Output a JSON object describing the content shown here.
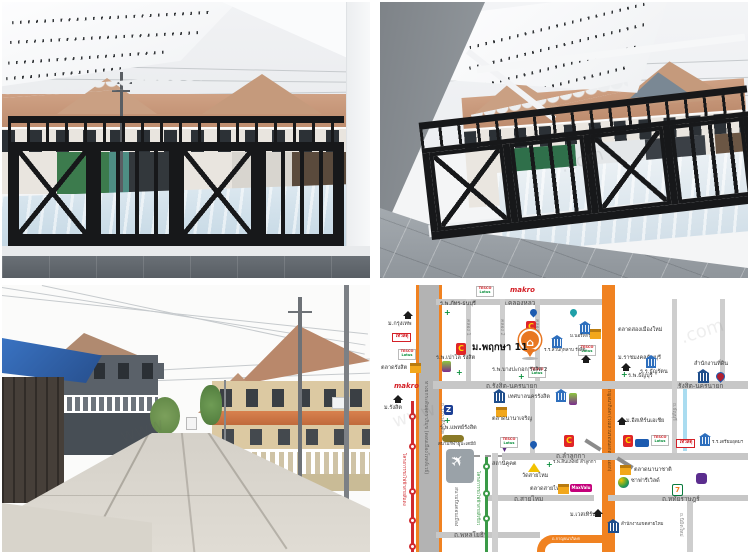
{
  "map": {
    "project": {
      "name": "ม.พฤกษา 11",
      "pin_glyph": "⌂"
    },
    "roads": {
      "klong_luang": "ถ.คลองหลวง",
      "rangsit_nakhonnayok": "ถ.รังสิต-นครนายก",
      "lam_lukka": "ถ.ลำลูกกา",
      "sai_mai": "ถ.สายไหม",
      "hathairat": "ถ.หทัยราษฎร์",
      "phahonyothin": "ถ.พหลโยธิน",
      "vibhavadi": "ถ.วิภาวดีรังสิต",
      "tollway": "ทางยกระดับอุตราภิมุข (ดอนเมืองโทลล์เวย์)",
      "kanchanaphisek": "ถ.กาญจนาภิเษก (วงแหวนรอบนอกตะวันออก)",
      "kanchanaphisek_short": "ถ.กาญจนาภิเษก",
      "nimit_mai": "ถ.นิมิตใหม่",
      "thanyaburi": "ถ.ธัญบุรี",
      "klong1": "คลอง 1",
      "klong2": "คลอง 2",
      "klong3": "คลอง 3"
    },
    "transit": {
      "red_line": "โครงการรถไฟฟ้าสายสีแดง",
      "green_line": "โครงการรถไฟฟ้าสายสีเขียว",
      "khu_khot": "สถานีคูคต",
      "don_mueang": "สนามบินดอนเมือง",
      "plane_glyph": "✈"
    },
    "places": {
      "bangkok_u": "ม.กรุงเทพ",
      "rangsit_u": "ม.รังสิต",
      "talad_rangsit": "ตลาดรังสิต",
      "phat_hospital": "ร.พ.ภัทร-ธนบุรี",
      "paolo_hospital": "ร.พ.เปาโล รังสิต",
      "bangpakok_hospital": "ร.พ.บางปะกอก รังสิต 2",
      "suan_kularb": "ร.ร.สวนกุหลาบ รังสิต",
      "north_bangkok_u": "ม.นอร์ทกรุงเทพ",
      "talad_muang_mai": "ตลาดสองเมืองใหม่",
      "rajamangala_u": "ม.ราชมงคลธัญบุรี",
      "thanyaburi_hospital": "ร.พ.ธัญบุรี",
      "thanyarat_school": "ร.ร.ธัญรัตน",
      "land_office": "สำนักงานที่ดิน",
      "city_hall": "เทศบาลนครรังสิต",
      "talad_nana_charoen": "ตลาดนานาเจริญ",
      "eastern_asia_u": "ม.อีสเทิร์นเอเชีย",
      "paet_rangsit_hospital": "ร.พ.แพทย์รังสิต",
      "stadium": "สนามกีฬาธูปะเตมีย์",
      "wat_sai_mai": "วัดสายไหม",
      "sinphaet_hospital": "ร.พ.สินแพทย์ ลำลูกกา",
      "talad_sai_mai": "ตลาดสายไหม",
      "talad_nana": "ตลาดนานาชาติ",
      "safari_world": "ซาฟารีเวิลด์",
      "western_u": "ม.เวสเทิร์น",
      "saimai_district": "สำนักงานเขตสายไหม",
      "triam_udom": "ร.ร.เตรียมอุดมฯ"
    },
    "brands": {
      "makro": "makro",
      "tesco_top": "TESCO",
      "tesco_bottom": "Lotus",
      "bigc": "C",
      "thaiwatsadu": "ไทวัสดุ",
      "maxvalu": "MaxValu",
      "seven": "7",
      "zeer": "Z"
    },
    "watermark": {
      "www": "www",
      "com": ".com"
    }
  }
}
